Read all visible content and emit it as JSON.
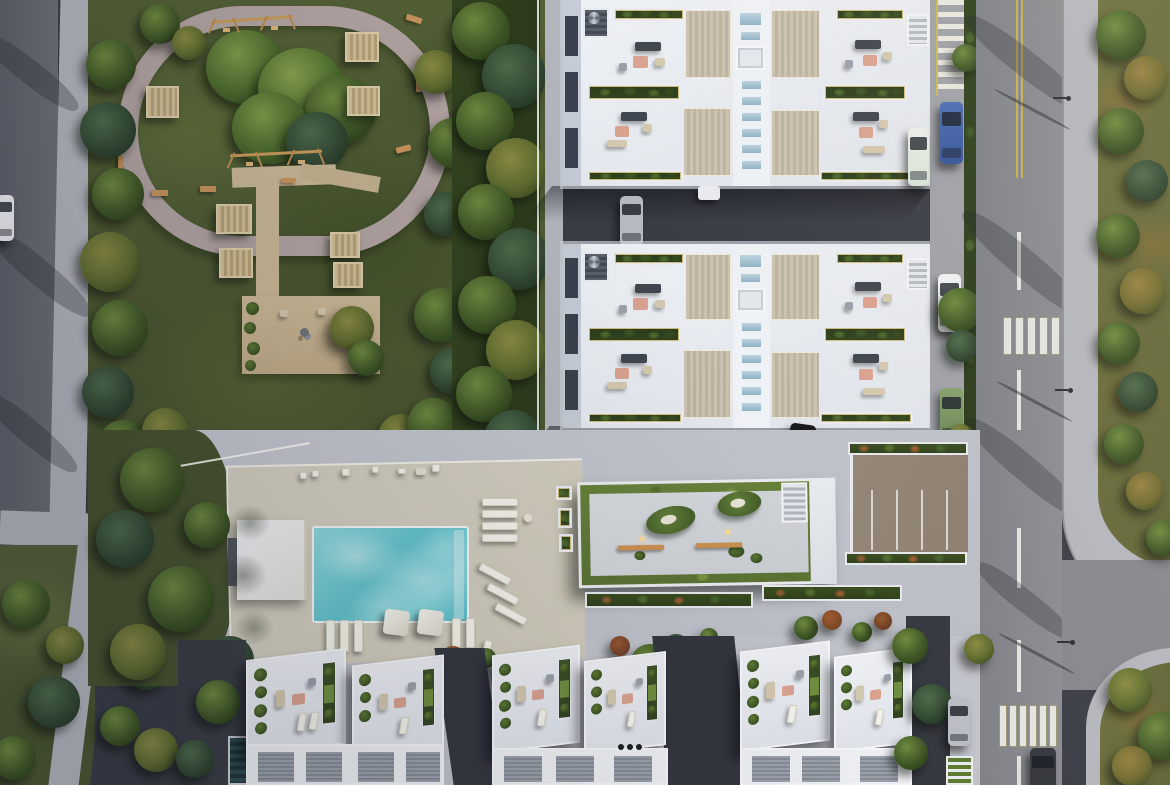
{
  "meta": {
    "title": "Aerial site plan rendering of residential complex",
    "view": "top-down drone render, afternoon sun from upper-right",
    "visible_text": "none"
  },
  "palette": {
    "asphaltDark": "#3a3d46",
    "asphaltRoad": "#85878d",
    "sidewalk": "#b4b6bd",
    "parkGrass": "#536035",
    "fieldGrass": "#6b6e3c",
    "treeHi": "#6d8a3e",
    "treeMid": "#3f5726",
    "treeDk": "#273a17",
    "buildingWhite": "#e9ecf1",
    "deckWood": "#c3baa9",
    "skylightBlue": "#a4bfd0",
    "greenRoof": "#66803a",
    "poolAqua": "#62c3cc",
    "poolLight": "#b5ecef",
    "deckBeige": "#cfcaba",
    "parkingBrown": "#8b7e6f",
    "lineYellow": "#c9ae4e",
    "stripeWhite": "#e3e4e0",
    "furniturePink": "#d9a28f",
    "furnitureBeige": "#d3c7ad"
  },
  "scene": {
    "park": {
      "label": "park with oval jogging loop, two swing sets, wooden pergolas, gravel plaza"
    },
    "buildings": {
      "label": "two white apartment blocks with roof terraces, wood decks, skylight spine, planters"
    },
    "pool": {
      "label": "turquoise pool with deck, loungers, two umbrellas, pool house"
    },
    "clubhouse": {
      "label": "amenity building with green roof border, organic seating islands, benches, stair"
    },
    "townhouses": {
      "label": "three clusters of skewed white townhouses with roof terraces and ribbed garage decks"
    },
    "roads": {
      "label": "main road right with two zebra crosswalks, dashed centerline, parking lane; street left; driveways"
    },
    "vehicles": [
      {
        "color": "white",
        "location": "left street"
      },
      {
        "color": "gray",
        "location": "courtyard between blocks"
      },
      {
        "color": "black",
        "location": "courtyard below second block"
      },
      {
        "color": "blue",
        "location": "parking lane top right"
      },
      {
        "color": "white-mint van",
        "location": "beside block A"
      },
      {
        "color": "white",
        "location": "parking lane mid right"
      },
      {
        "color": "green",
        "location": "parking lane right"
      },
      {
        "color": "silver",
        "location": "under trees bottom right"
      },
      {
        "color": "dark gray",
        "location": "driving on main road bottom"
      }
    ],
    "crosswalk_upper_stripes": 5,
    "crosswalk_lower_stripes": 6
  }
}
